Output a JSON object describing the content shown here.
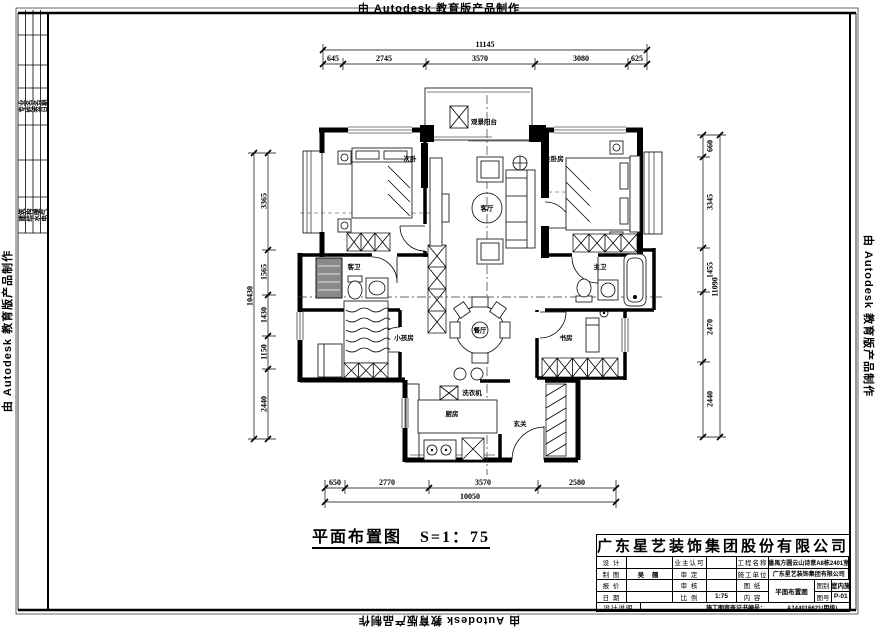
{
  "watermark": {
    "text": "由 Autodesk 教育版产品制作"
  },
  "plan_title": {
    "text": "平面布置图",
    "scale": "S=1：75"
  },
  "rooms": {
    "balcony_top": "观景阳台",
    "bedroom2": "次卧",
    "master_bedroom": "主卧房",
    "living_room": "客厅",
    "dining_room": "餐厅",
    "kids_room": "小孩房",
    "guest_bath": "客卫",
    "master_bath": "主卫",
    "kitchen": "厨房",
    "entry": "玄关",
    "study": "书房",
    "washer": "洗衣机"
  },
  "dimensions": {
    "top": {
      "total": "11145",
      "segments": [
        "645",
        "2745",
        "3570",
        "3080",
        "625"
      ]
    },
    "bottom": {
      "total": "10050",
      "segments": [
        "650",
        "2770",
        "3570",
        "2580"
      ]
    },
    "left": {
      "total": "10430",
      "segments": [
        "3365",
        "1565",
        "1430",
        "1150",
        "2440"
      ]
    },
    "right": {
      "total": "11090",
      "segments": [
        "660",
        "3345",
        "1455",
        "2470",
        "2440"
      ]
    }
  },
  "signature_strip": {
    "group1": [
      "专业",
      "姓名",
      "签名",
      "日期"
    ],
    "group2": [
      "建筑",
      "结构",
      "水暖",
      "电气"
    ]
  },
  "title_block": {
    "company": "广东星艺装饰集团股份有限公司",
    "design_label": "设 计",
    "owner_label": "业主认可",
    "project_label": "工程名称",
    "project_value": "番禺方圆云山诗意A8栋2401室",
    "draft_label": "制 图",
    "draft_value": "吴 翘",
    "approve_label": "审 定",
    "builder_label": "施工单位",
    "builder_value": "广东星艺装饰集团有限公司",
    "quote_label": "报 价",
    "check_label": "审 核",
    "sheet_label": "图 纸",
    "date_label": "日 期",
    "ratio_label": "比 例",
    "ratio_value": "1:75",
    "content_label": "内 容",
    "content_value": "平面布置图",
    "cat_label": "图别",
    "cat_value": "室内施",
    "no_label": "图号",
    "no_value": "P-01",
    "note_label": "设计说明",
    "cert_label": "施工图审查证书编号：",
    "cert_value": "A144016621(甲级)"
  }
}
